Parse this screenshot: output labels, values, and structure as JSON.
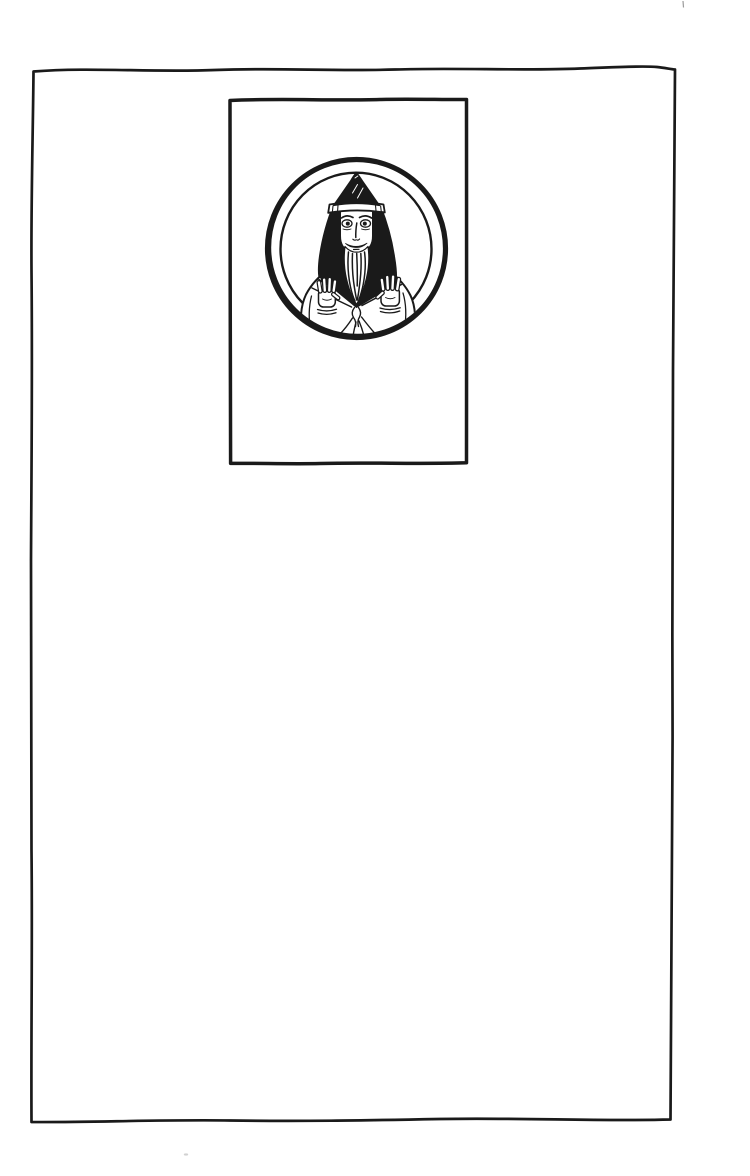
{
  "page": {
    "kind": "scanned-book-page",
    "content_text": "",
    "colors": {
      "paper": "#ffffff",
      "ink": "#1a1a1a",
      "faint_mark": "#9a9a9a",
      "smudge_mark": "#c6c6c6"
    }
  },
  "illustration": {
    "label": "portrait-medallion-woodcut",
    "subject": "bearded man wearing a pointed hood, palms raised outward",
    "elements": [
      "page-border-frame",
      "plate-frame",
      "medallion-outer-ring",
      "medallion-inner-ring",
      "pointed-hood",
      "brow-band",
      "face",
      "eyes",
      "beard",
      "hair",
      "robe",
      "collar-sash",
      "left-hand",
      "right-hand",
      "drapery-folds"
    ]
  }
}
